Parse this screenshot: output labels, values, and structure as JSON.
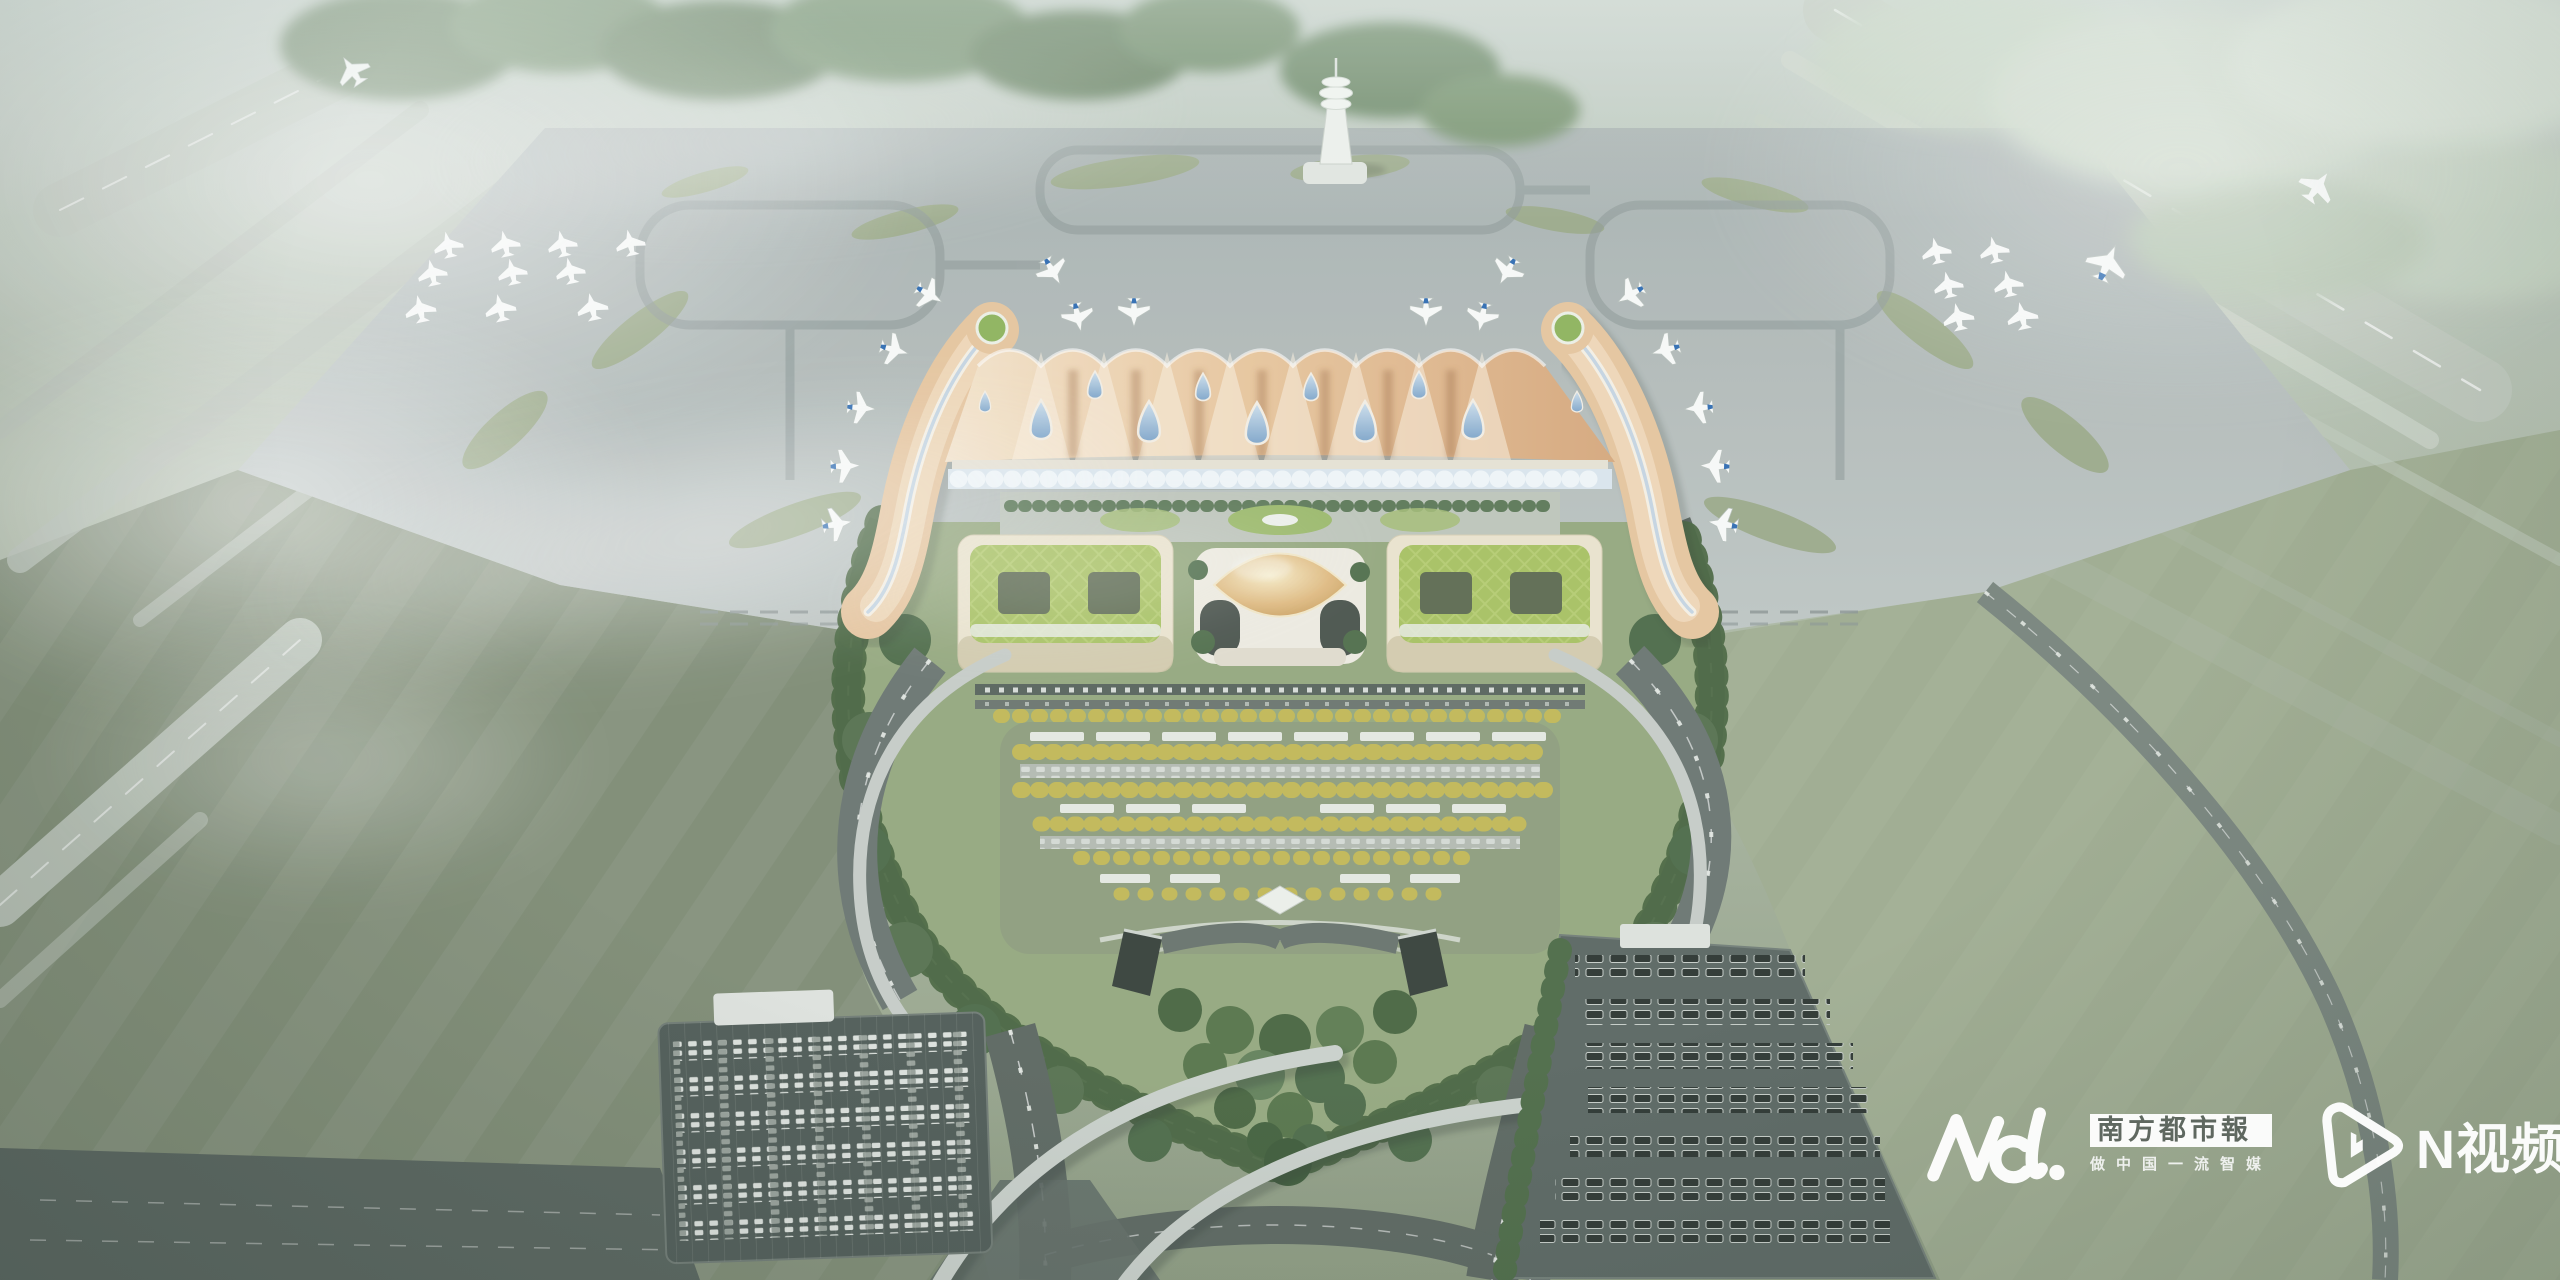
{
  "scene": {
    "kind": "aerial architectural rendering",
    "subject": "airport terminal complex: wave-roofed main terminal with teardrop skylights, two curved golden boarding piers with parked jets, golden dome landside hall flanked by green-roof buildings, teardrop access loop with gardens, car and coach parking lots, highways, control tower, foggy airfield",
    "weather": "hazy morning, low fog over airfield"
  },
  "watermarks": {
    "southern_metropolis_daily": {
      "logo_text": "Nd.",
      "newspaper_name": "南方都市報",
      "slogan": "做中国一流智媒"
    },
    "n_video": {
      "label": "N视频",
      "icon": "play-triangle-icon"
    }
  },
  "palette": {
    "roof_peach": "#eac79e",
    "dome_gold": "#ddb678",
    "green_roof": "#a8c261",
    "skylight_blue": "#8fb3d8",
    "apron_gray": "#aeb7b5",
    "grass_olive": "#7e8b74",
    "grass_sage": "#9fac90",
    "road_asphalt": "#59645e",
    "tree_dark_green": "#4c6a47",
    "tree_autumn_yellow": "#c3b955",
    "fog_white": "#ffffff",
    "tail_blue": "#2f6cb3"
  }
}
